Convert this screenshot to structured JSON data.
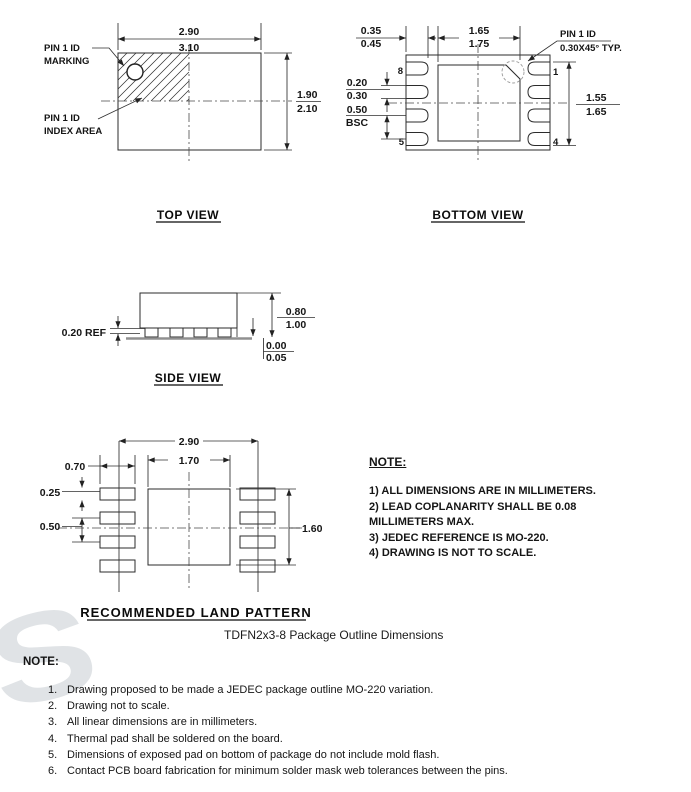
{
  "watermark": {
    "glyph": "S"
  },
  "top_view": {
    "title": "TOP VIEW",
    "pin1_marking_label": [
      "PIN 1 ID",
      "MARKING"
    ],
    "pin1_index_label": [
      "PIN 1 ID",
      "INDEX AREA"
    ],
    "dim_width": {
      "upper": "2.90",
      "lower": "3.10"
    },
    "dim_height": {
      "upper": "1.90",
      "lower": "2.10"
    }
  },
  "bottom_view": {
    "title": "BOTTOM VIEW",
    "dim_lead_length": {
      "upper": "0.35",
      "lower": "0.45"
    },
    "dim_epad_width": {
      "upper": "1.65",
      "lower": "1.75"
    },
    "dim_lead_width": {
      "upper": "0.20",
      "lower": "0.30"
    },
    "dim_pitch": {
      "upper": "0.50",
      "lower": "BSC"
    },
    "dim_epad_height": {
      "upper": "1.55",
      "lower": "1.65"
    },
    "pin1_label": [
      "PIN 1 ID",
      "0.30X45° TYP."
    ],
    "pins": {
      "top_left": "8",
      "bottom_left": "5",
      "top_right": "1",
      "bottom_right": "4"
    }
  },
  "side_view": {
    "title": "SIDE VIEW",
    "dim_lead_thickness": "0.20 REF",
    "dim_height": {
      "upper": "0.80",
      "lower": "1.00"
    },
    "dim_standoff": {
      "upper": "0.00",
      "lower": "0.05"
    }
  },
  "land_pattern": {
    "title": "RECOMMENDED LAND PATTERN",
    "dim_span": "2.90",
    "dim_epad_width": "1.70",
    "dim_pad_length": "0.70",
    "dim_pad_width": "0.25",
    "dim_pitch": "0.50",
    "dim_height": "1.60"
  },
  "note_block": {
    "heading": "NOTE:",
    "lines": [
      "1) ALL DIMENSIONS ARE IN MILLIMETERS.",
      "2) LEAD COPLANARITY SHALL BE 0.08",
      "MILLIMETERS MAX.",
      "3) JEDEC REFERENCE IS MO-220.",
      "4) DRAWING IS NOT TO SCALE."
    ]
  },
  "doc_title": "TDFN2x3-8 Package Outline Dimensions",
  "footer": {
    "heading": "NOTE:",
    "items": [
      {
        "num": "1.",
        "text": "Drawing proposed to be made a JEDEC package outline MO-220 variation."
      },
      {
        "num": "2.",
        "text": "Drawing not to scale."
      },
      {
        "num": "3.",
        "text": "All linear dimensions are in millimeters."
      },
      {
        "num": "4.",
        "text": "Thermal pad shall be soldered on the board."
      },
      {
        "num": "5.",
        "text": "Dimensions of exposed pad on bottom of package do not include mold flash."
      },
      {
        "num": "6.",
        "text": "Contact PCB board fabrication for minimum solder mask web tolerances between the pins."
      }
    ]
  }
}
